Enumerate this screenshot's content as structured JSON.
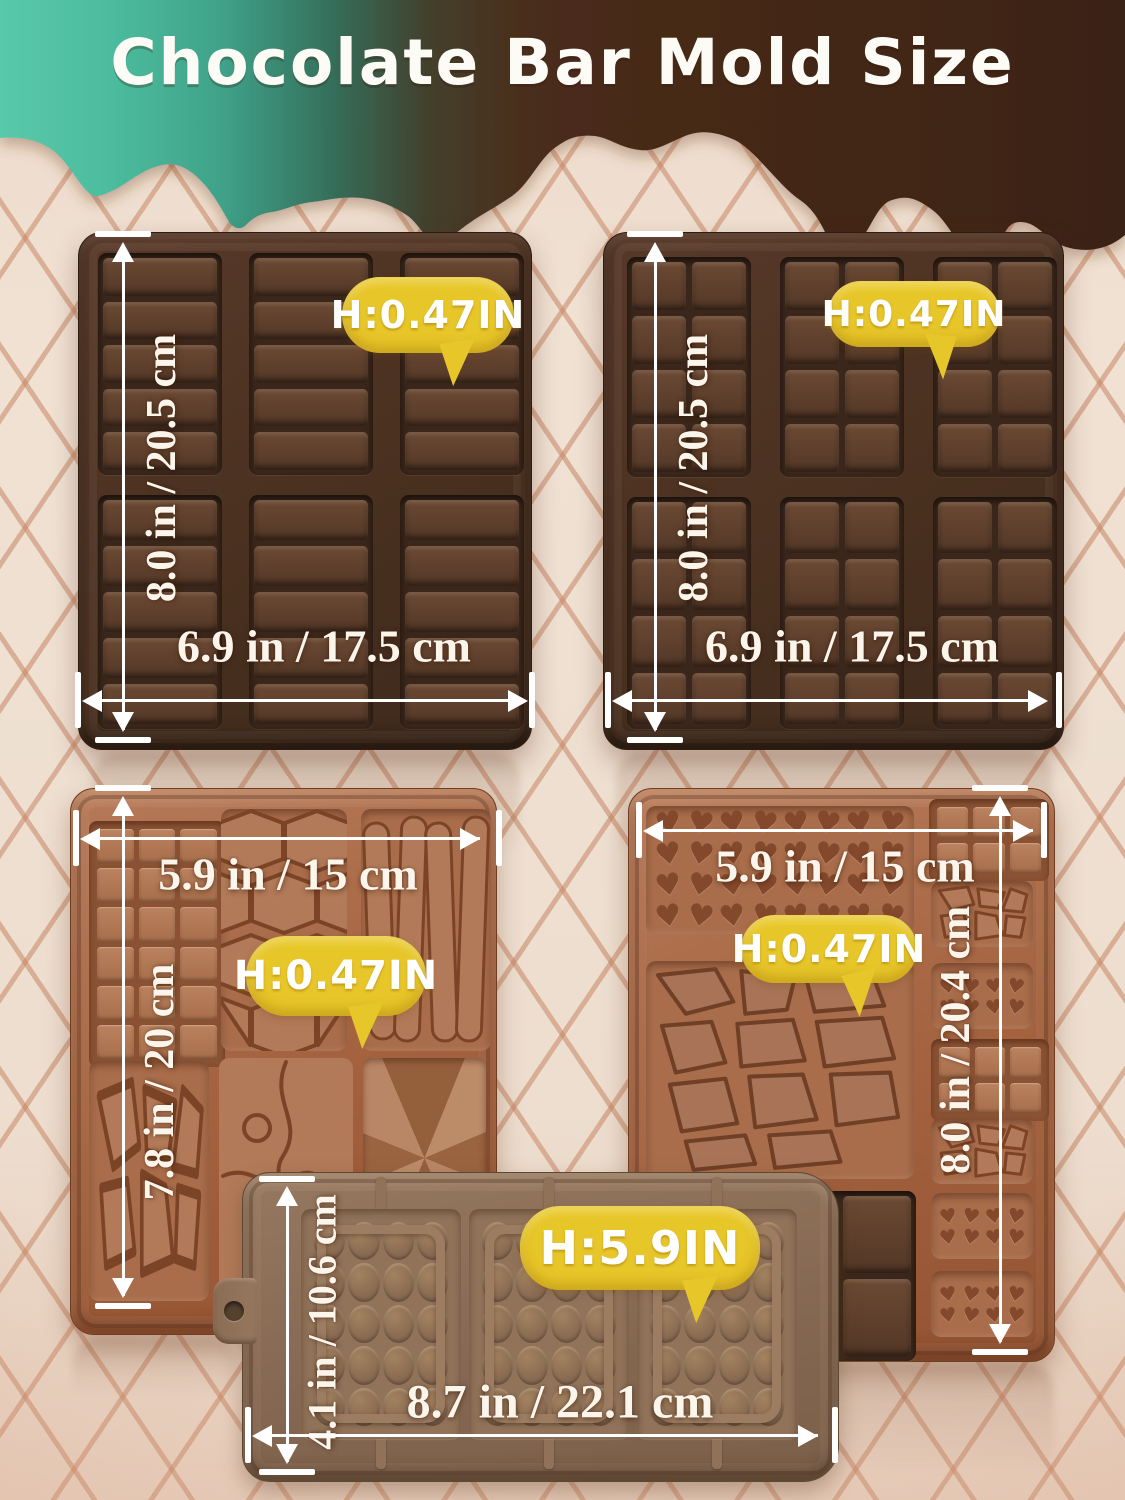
{
  "title": "Chocolate Bar Mold Size",
  "molds": {
    "top_left": {
      "height_badge": "H:0.47IN",
      "width_label": "6.9 in / 17.5 cm",
      "height_label": "8.0 in / 20.5 cm"
    },
    "top_right": {
      "height_badge": "H:0.47IN",
      "width_label": "6.9 in / 17.5 cm",
      "height_label": "8.0 in / 20.5 cm"
    },
    "mid_left": {
      "height_badge": "H:0.47IN",
      "width_label": "5.9 in / 15 cm",
      "height_label": "7.8 in / 20 cm"
    },
    "mid_right": {
      "height_badge": "H:0.47IN",
      "width_label": "5.9 in / 15 cm",
      "height_label": "8.0 in / 20.4 cm"
    },
    "bottom": {
      "height_badge": "H:5.9IN",
      "width_label": "8.7 in / 22.1 cm",
      "height_label": "4.1 in / 10.6 cm"
    }
  },
  "colors": {
    "badge_yellow": "#e7c629",
    "teal_drip": "#52c3a5",
    "chocolate_drip": "#44291a",
    "dark_mold": "#4e3426",
    "caramel_mold": "#a96c4a",
    "taupe_mold": "#8d7158",
    "background": "#eedfd1",
    "lattice_line": "#c68665",
    "annotation_white": "#ffffff"
  }
}
